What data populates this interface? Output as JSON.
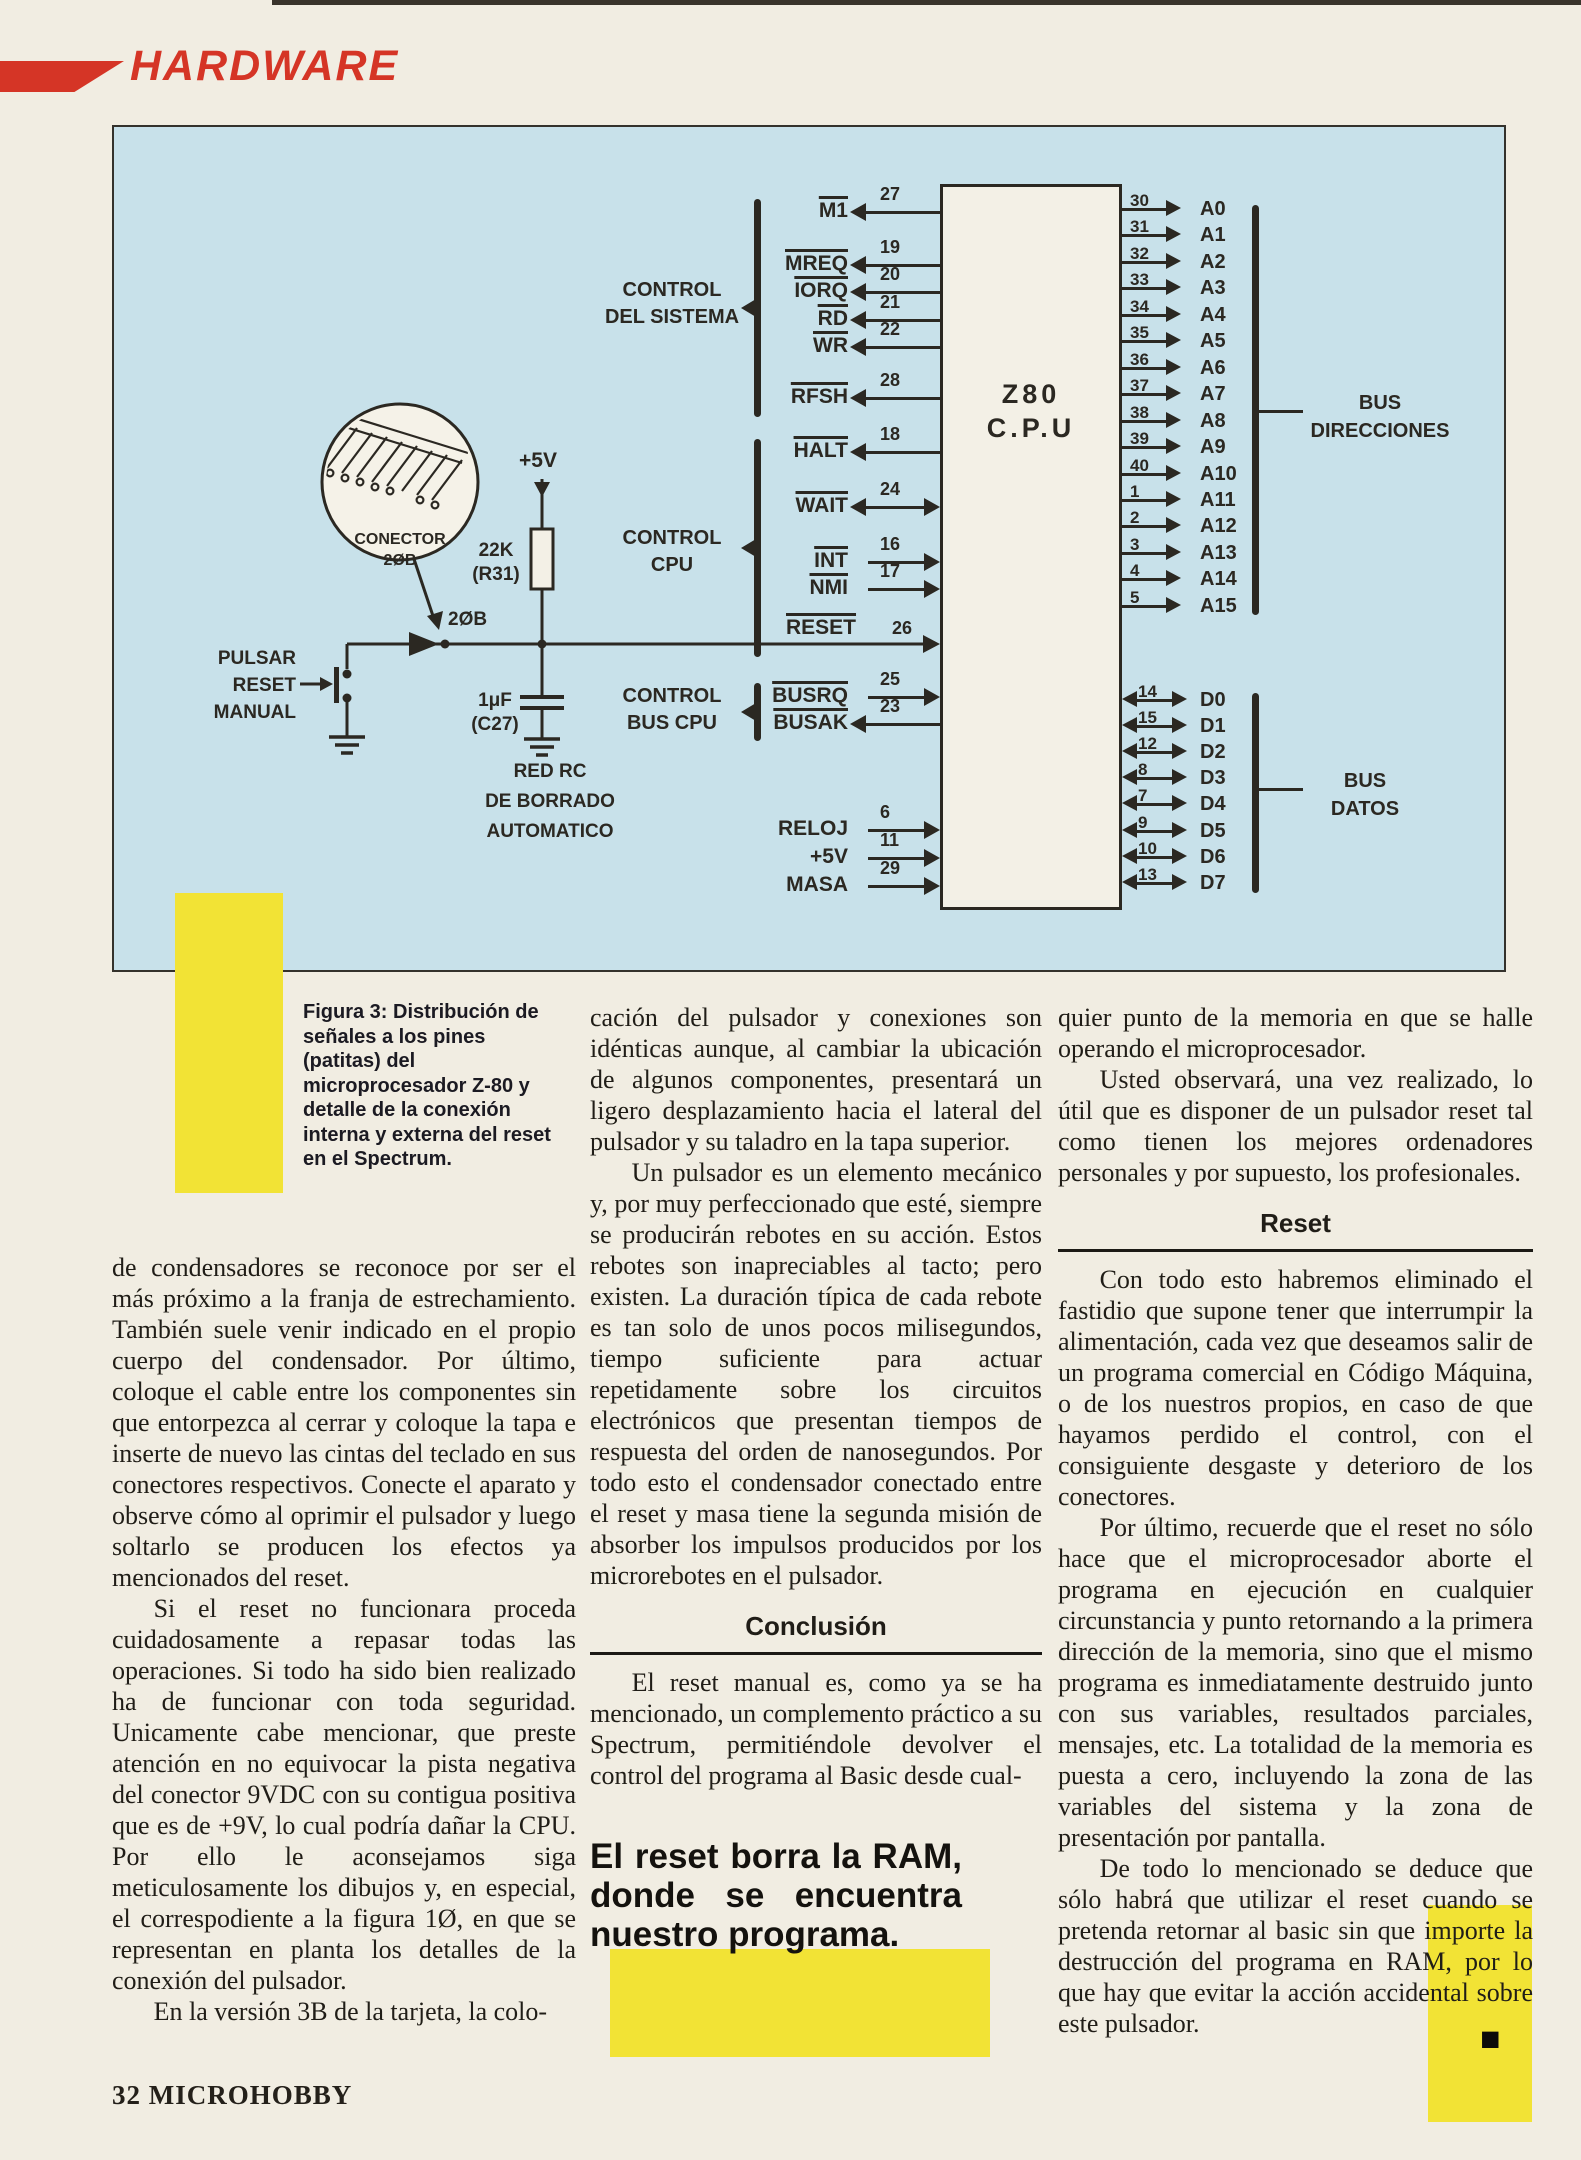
{
  "colors": {
    "accent_red": "#d53526",
    "highlight_yellow": "#f2e335",
    "diagram_blue": "#c8e1ea",
    "ink": "#2b2822"
  },
  "header": {
    "section": "HARDWARE"
  },
  "diagram": {
    "cpu": {
      "line1": "Z80",
      "line2": "C.P.U"
    },
    "left_signals": [
      {
        "name": "M1",
        "pin": "27"
      },
      {
        "name": "MREQ",
        "pin": "19"
      },
      {
        "name": "IORQ",
        "pin": "20"
      },
      {
        "name": "RD",
        "pin": "21"
      },
      {
        "name": "WR",
        "pin": "22"
      },
      {
        "name": "RFSH",
        "pin": "28"
      },
      {
        "name": "HALT",
        "pin": "18"
      },
      {
        "name": "WAIT",
        "pin": "24"
      },
      {
        "name": "INT",
        "pin": "16"
      },
      {
        "name": "NMI",
        "pin": "17"
      },
      {
        "name": "RESET",
        "pin": "26"
      },
      {
        "name": "BUSRQ",
        "pin": "25"
      },
      {
        "name": "BUSAK",
        "pin": "23"
      },
      {
        "name": "RELOJ",
        "pin": "6"
      },
      {
        "name": "+5V",
        "pin": "11"
      },
      {
        "name": "MASA",
        "pin": "29"
      }
    ],
    "groups": {
      "system": {
        "line1": "CONTROL",
        "line2": "DEL SISTEMA"
      },
      "cpu": {
        "line1": "CONTROL",
        "line2": "CPU"
      },
      "bus": {
        "line1": "CONTROL",
        "line2": "BUS CPU"
      }
    },
    "address_pins": [
      {
        "pin": "30",
        "name": "A0"
      },
      {
        "pin": "31",
        "name": "A1"
      },
      {
        "pin": "32",
        "name": "A2"
      },
      {
        "pin": "33",
        "name": "A3"
      },
      {
        "pin": "34",
        "name": "A4"
      },
      {
        "pin": "35",
        "name": "A5"
      },
      {
        "pin": "36",
        "name": "A6"
      },
      {
        "pin": "37",
        "name": "A7"
      },
      {
        "pin": "38",
        "name": "A8"
      },
      {
        "pin": "39",
        "name": "A9"
      },
      {
        "pin": "40",
        "name": "A10"
      },
      {
        "pin": "1",
        "name": "A11"
      },
      {
        "pin": "2",
        "name": "A12"
      },
      {
        "pin": "3",
        "name": "A13"
      },
      {
        "pin": "4",
        "name": "A14"
      },
      {
        "pin": "5",
        "name": "A15"
      }
    ],
    "data_pins": [
      {
        "pin": "14",
        "name": "D0"
      },
      {
        "pin": "15",
        "name": "D1"
      },
      {
        "pin": "12",
        "name": "D2"
      },
      {
        "pin": "8",
        "name": "D3"
      },
      {
        "pin": "7",
        "name": "D4"
      },
      {
        "pin": "9",
        "name": "D5"
      },
      {
        "pin": "10",
        "name": "D6"
      },
      {
        "pin": "13",
        "name": "D7"
      }
    ],
    "bus_direcciones": {
      "line1": "BUS",
      "line2": "DIRECCIONES"
    },
    "bus_datos": {
      "line1": "BUS",
      "line2": "DATOS"
    },
    "connector": {
      "line1": "CONECTOR",
      "line2": "2ØB"
    },
    "junction": "2ØB",
    "supply": "+5V",
    "resistor": {
      "line1": "22K",
      "line2": "(R31)"
    },
    "capacitor": {
      "line1": "1μF",
      "line2": "(C27)"
    },
    "switch_label": {
      "line1": "PULSAR",
      "line2": "RESET",
      "line3": "MANUAL"
    },
    "rc_label": {
      "line1": "RED RC",
      "line2": "DE BORRADO",
      "line3": "AUTOMATICO"
    }
  },
  "caption": "Figura 3: Distribución de señales a los pines (patitas) del microprocesador Z-80 y detalle de la conexión interna y externa del reset en el Spectrum.",
  "columns": {
    "col1": {
      "p1": "de condensadores se reconoce por ser el más próximo a la franja de estrechamiento. También suele venir indicado en el propio cuerpo del condensador. Por último, coloque el cable entre los componentes sin que entorpezca al cerrar y coloque la tapa e inserte de nuevo las cintas del teclado en sus conectores respectivos. Conecte el aparato y observe cómo al oprimir el pulsador y luego soltarlo se producen los efectos ya mencionados del reset.",
      "p2": "Si el reset no funcionara proceda cuidadosamente a repasar todas las operaciones. Si todo ha sido bien realizado ha de funcionar con toda seguridad. Unicamente cabe mencionar, que preste atención en no equivocar la pista negativa del conector 9VDC con su contigua positiva que es de +9V, lo cual podría dañar la CPU. Por ello le aconsejamos siga meticulosamente los dibujos y, en especial, el correspodiente a la figura 1Ø, en que se representan en planta los detalles de la conexión del pulsador.",
      "p3": "En la versión 3B de la tarjeta, la colo-"
    },
    "col2": {
      "p1": "cación del pulsador y conexiones son idénticas aunque, al cambiar la ubicación de algunos componentes, presentará un ligero desplazamiento hacia el lateral del pulsador y su taladro en la tapa superior.",
      "p2": "Un pulsador es un elemento mecánico y, por muy perfeccionado que esté, siempre se producirán rebotes en su acción. Estos rebotes son inapreciables al tacto; pero existen. La duración típica de cada rebote es tan solo de unos pocos milisegundos, tiempo suficiente para actuar repetidamente sobre los circuitos electrónicos que presentan tiempos de respuesta del orden de nanosegundos. Por todo esto el condensador conectado entre el reset y masa tiene la segunda misión de absorber los impulsos producidos por los microrebotes en el pulsador.",
      "heading": "Conclusión",
      "p3": "El reset manual es, como ya se ha mencionado, un complemento práctico a su Spectrum, permitiéndole devolver el control del programa al Basic desde cual-"
    },
    "quote": "El reset borra la RAM, donde se encuentra nuestro programa.",
    "col3": {
      "p1": "quier punto de la memoria en que se halle operando el microprocesador.",
      "p2": "Usted observará, una vez realizado, lo útil que es disponer de un pulsador reset tal como tienen los mejores ordenadores personales y por supuesto, los profesionales.",
      "heading": "Reset",
      "p3": "Con todo esto habremos eliminado el fastidio que supone tener que interrumpir la alimentación, cada vez que deseamos salir de un programa comercial en Código Máquina, o de los nuestros propios, en caso de que hayamos perdido el control, con el consiguiente desgaste y deterioro de los conectores.",
      "p4": "Por último, recuerde que el reset no sólo hace que el microprocesador aborte el programa en ejecución en cualquier circunstancia y punto retornando a la primera dirección de la memoria, sino que el mismo programa es inmediatamente destruido junto con sus variables, resultados parciales, mensajes, etc. La totalidad de la memoria es puesta a cero, incluyendo la zona de las variables del sistema y la zona de presentación por pantalla.",
      "p5": "De todo lo mencionado se deduce que sólo habrá que utilizar el reset cuando se pretenda retornar al basic sin que importe la destrucción del programa en RAM, por lo que hay que evitar la acción accidental sobre este pulsador.",
      "end_mark": "■"
    }
  },
  "footer": {
    "page_number": "32",
    "magazine": "MICROHOBBY"
  }
}
